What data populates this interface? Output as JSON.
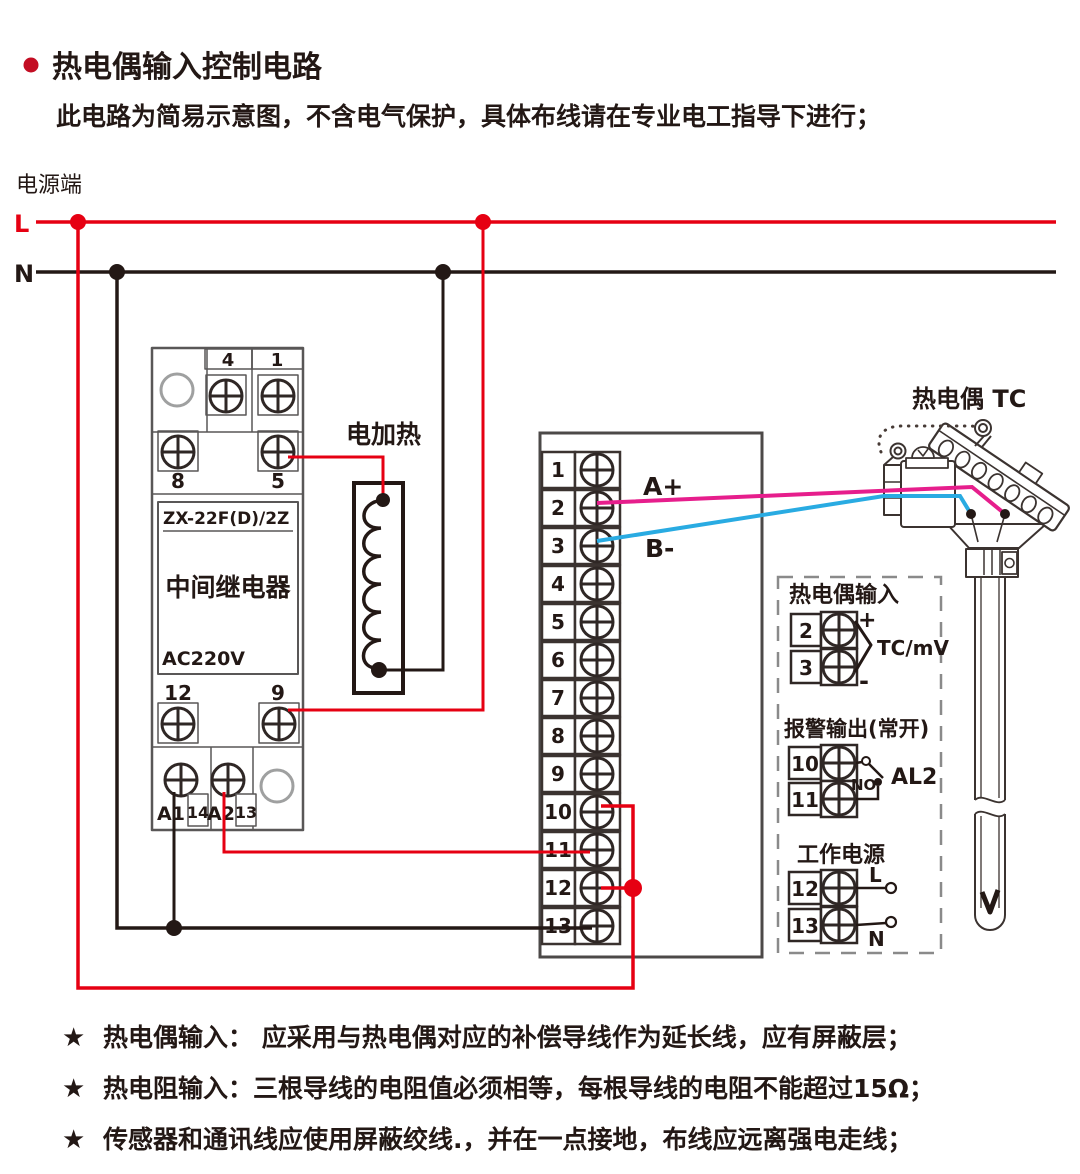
{
  "header": {
    "title": "热电偶输入控制电路",
    "subtitle": "此电路为简易示意图，不含电气保护，具体布线请在专业电工指导下进行；"
  },
  "power": {
    "label": "电源端",
    "l": "L",
    "n": "N"
  },
  "relay": {
    "model": "ZX-22F(D)/2Z",
    "name": "中间继电器",
    "voltage": "AC220V",
    "t4": "4",
    "t1": "1",
    "t8": "8",
    "t5": "5",
    "t12": "12",
    "t9": "9",
    "a1": "A1",
    "t14": "14",
    "a2": "A2",
    "t13": "13"
  },
  "heater": {
    "label": "电加热"
  },
  "block": {
    "terminals": [
      "1",
      "2",
      "3",
      "4",
      "5",
      "6",
      "7",
      "8",
      "9",
      "10",
      "11",
      "12",
      "13"
    ]
  },
  "signals": {
    "a_plus": "A+",
    "b_minus": "B-"
  },
  "thermocouple": {
    "label": "热电偶 TC"
  },
  "panel": {
    "tc": {
      "title": "热电偶输入",
      "t2": "2",
      "t3": "3",
      "plus": "+",
      "minus": "-",
      "range": "TC/mV"
    },
    "alarm": {
      "title": "报警输出(常开)",
      "t10": "10",
      "t11": "11",
      "no": "NO",
      "name": "AL2"
    },
    "supply": {
      "title": "工作电源",
      "t12": "12",
      "t13": "13",
      "l": "L",
      "n": "N"
    }
  },
  "notes": [
    {
      "bullet": "★",
      "text": "热电偶输入： 应采用与热电偶对应的补偿导线作为延长线，应有屏蔽层；"
    },
    {
      "bullet": "★",
      "text": "热电阻输入：三根导线的电阻值必须相等，每根导线的电阻不能超过15Ω；"
    },
    {
      "bullet": "★",
      "text": "传感器和通讯线应使用屏蔽绞线.，并在一点接地，布线应远离强电走线；"
    }
  ],
  "colors": {
    "line_red": "#e60012",
    "wire_pink": "#e61e8c",
    "wire_blue": "#29abe2",
    "wire_black": "#231815",
    "bullet_red": "#c30d23",
    "component_gray": "#595757",
    "dash_gray": "#8a8a8a"
  }
}
